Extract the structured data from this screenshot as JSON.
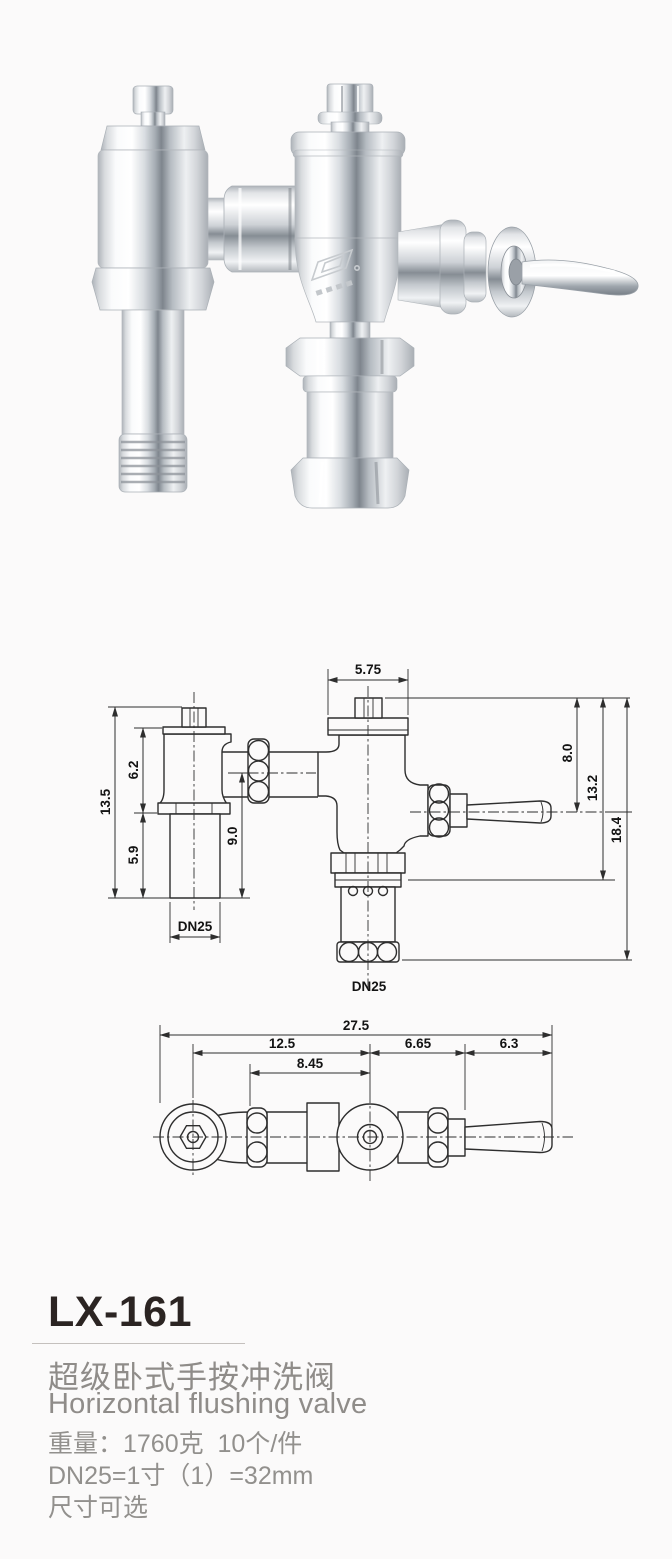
{
  "page": {
    "background": "#fbfafa",
    "title_color": "#2b2422",
    "muted_text_color": "#8f8c89",
    "drawing_line_color": "#2e2e2e"
  },
  "product": {
    "model": "LX-161",
    "name_zh": "超级卧式手按冲洗阀",
    "name_en": "Horizontal flushing valve",
    "specs": [
      "重量：1760克  10个/件",
      "DN25=1寸（1）=32mm",
      "尺寸可选"
    ]
  },
  "drawing_side": {
    "dims": {
      "cap_width": "5.75",
      "left_total_height": "13.5",
      "left_upper_height": "6.2",
      "left_lower_height": "5.9",
      "inlet_center_height": "9.0",
      "top_to_handle": "8.0",
      "top_to_outlet_nut": "13.2",
      "right_total_height": "18.4",
      "left_outlet": "DN25",
      "bottom_outlet": "DN25"
    }
  },
  "drawing_top": {
    "dims": {
      "total_length": "27.5",
      "flange_to_valve_center": "12.5",
      "valve_center_to_hub": "6.65",
      "handle_length": "6.3",
      "coupling_to_valve_center": "8.45"
    }
  }
}
